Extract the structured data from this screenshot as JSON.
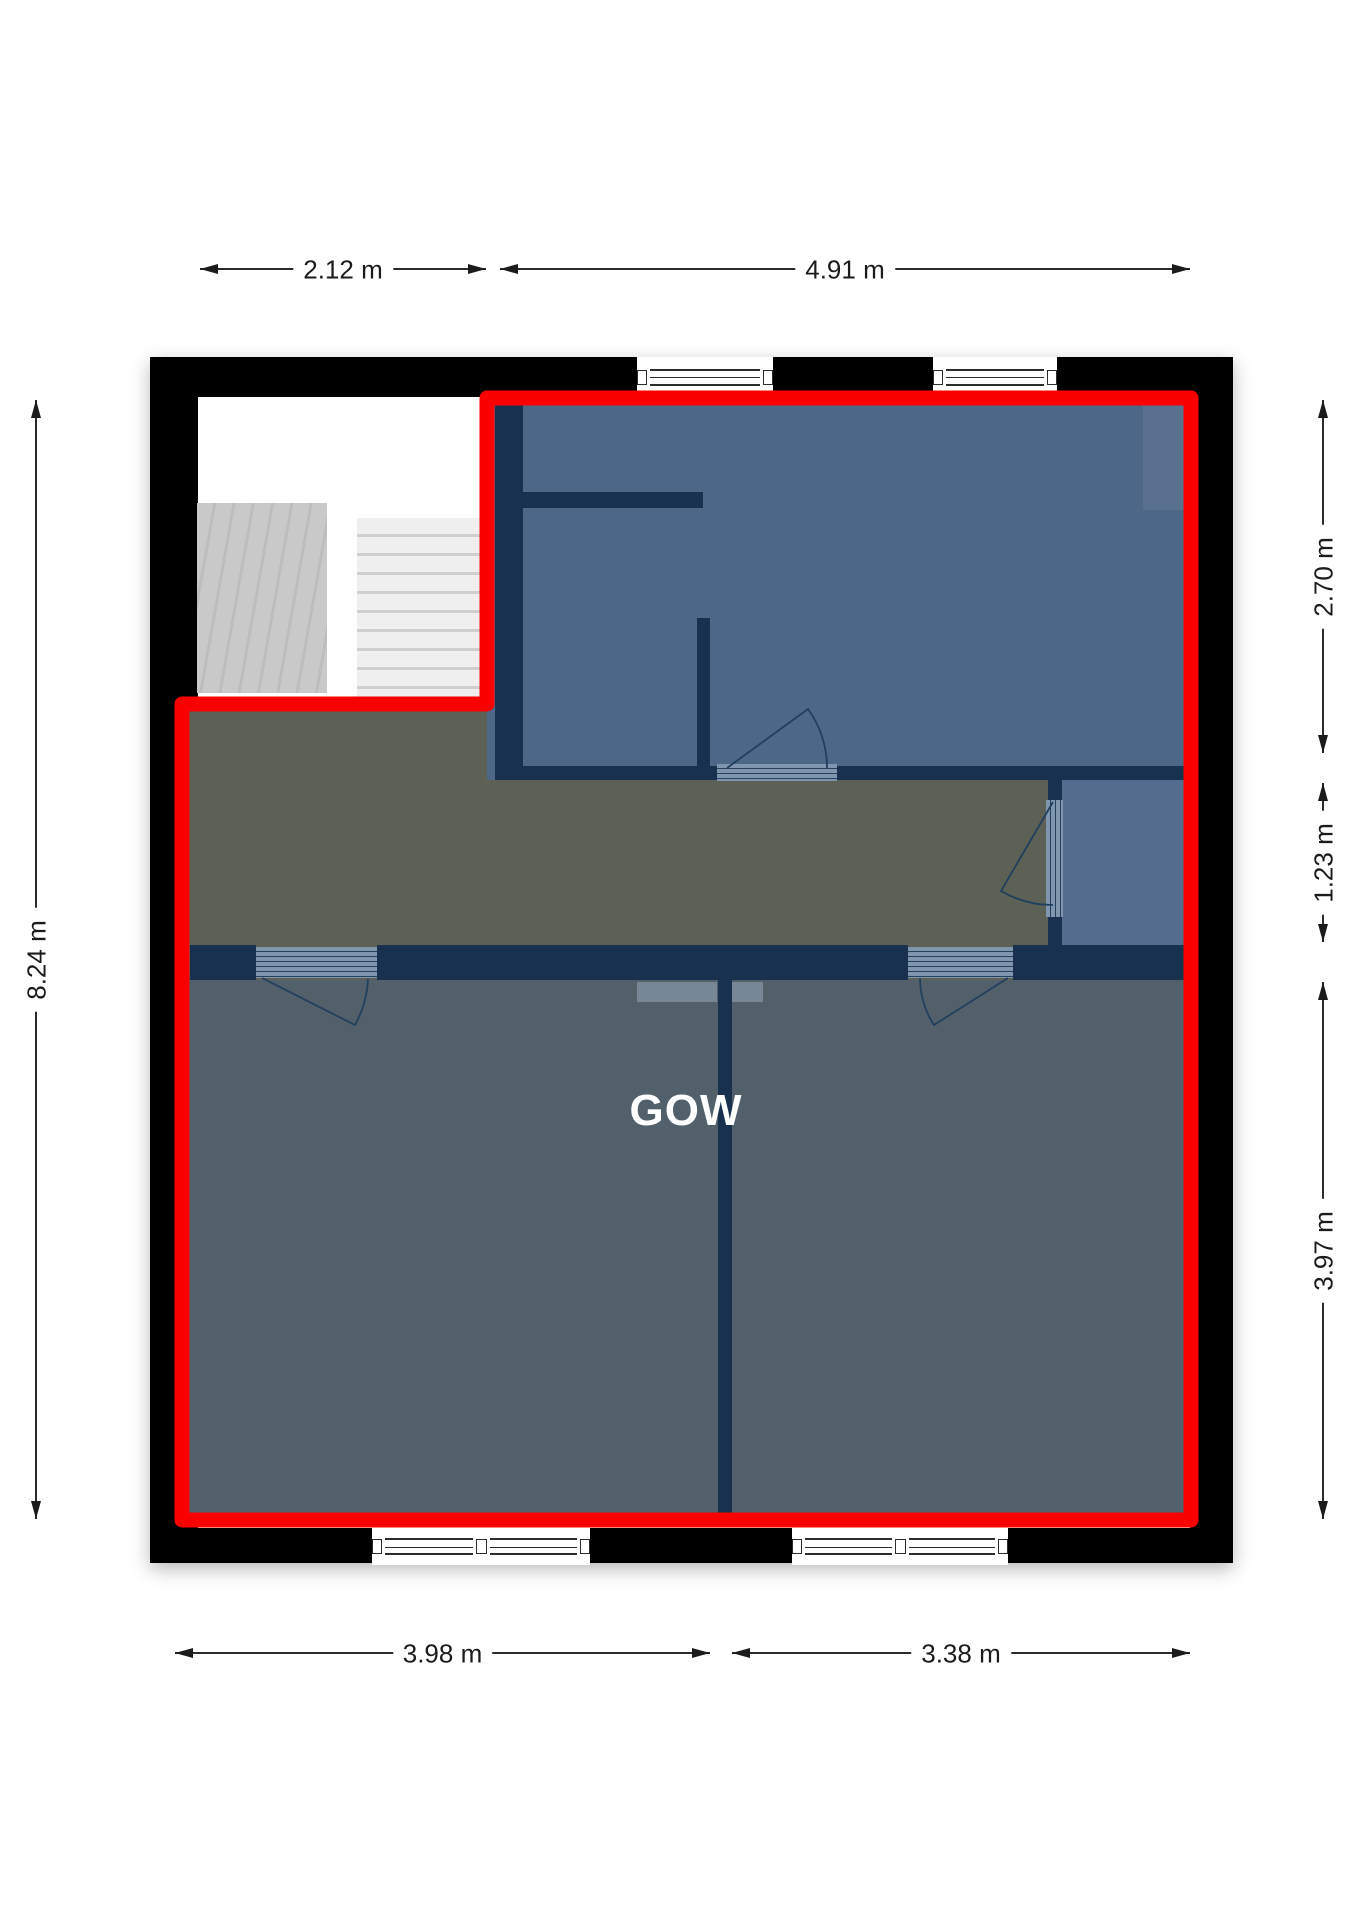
{
  "plan": {
    "room_label": "GOW"
  },
  "dimensions": {
    "top": [
      {
        "label": "2.12 m"
      },
      {
        "label": "4.91 m"
      }
    ],
    "bottom": [
      {
        "label": "3.98 m"
      },
      {
        "label": "3.38 m"
      }
    ],
    "left": [
      {
        "label": "8.24 m"
      }
    ],
    "right": [
      {
        "label": "2.70 m"
      },
      {
        "label": "1.23 m"
      },
      {
        "label": "3.97 m"
      }
    ]
  },
  "colors": {
    "outline": "#fb0000",
    "walls": "#000000",
    "interior_wall": "#17314e",
    "room_blue": "#4d6787",
    "closet_blue": "#546c8d",
    "hall": "#5d6055",
    "lower_rooms": "#52606c",
    "dimension_text": "#1b1b1b",
    "room_label_color": "#ffffff"
  }
}
